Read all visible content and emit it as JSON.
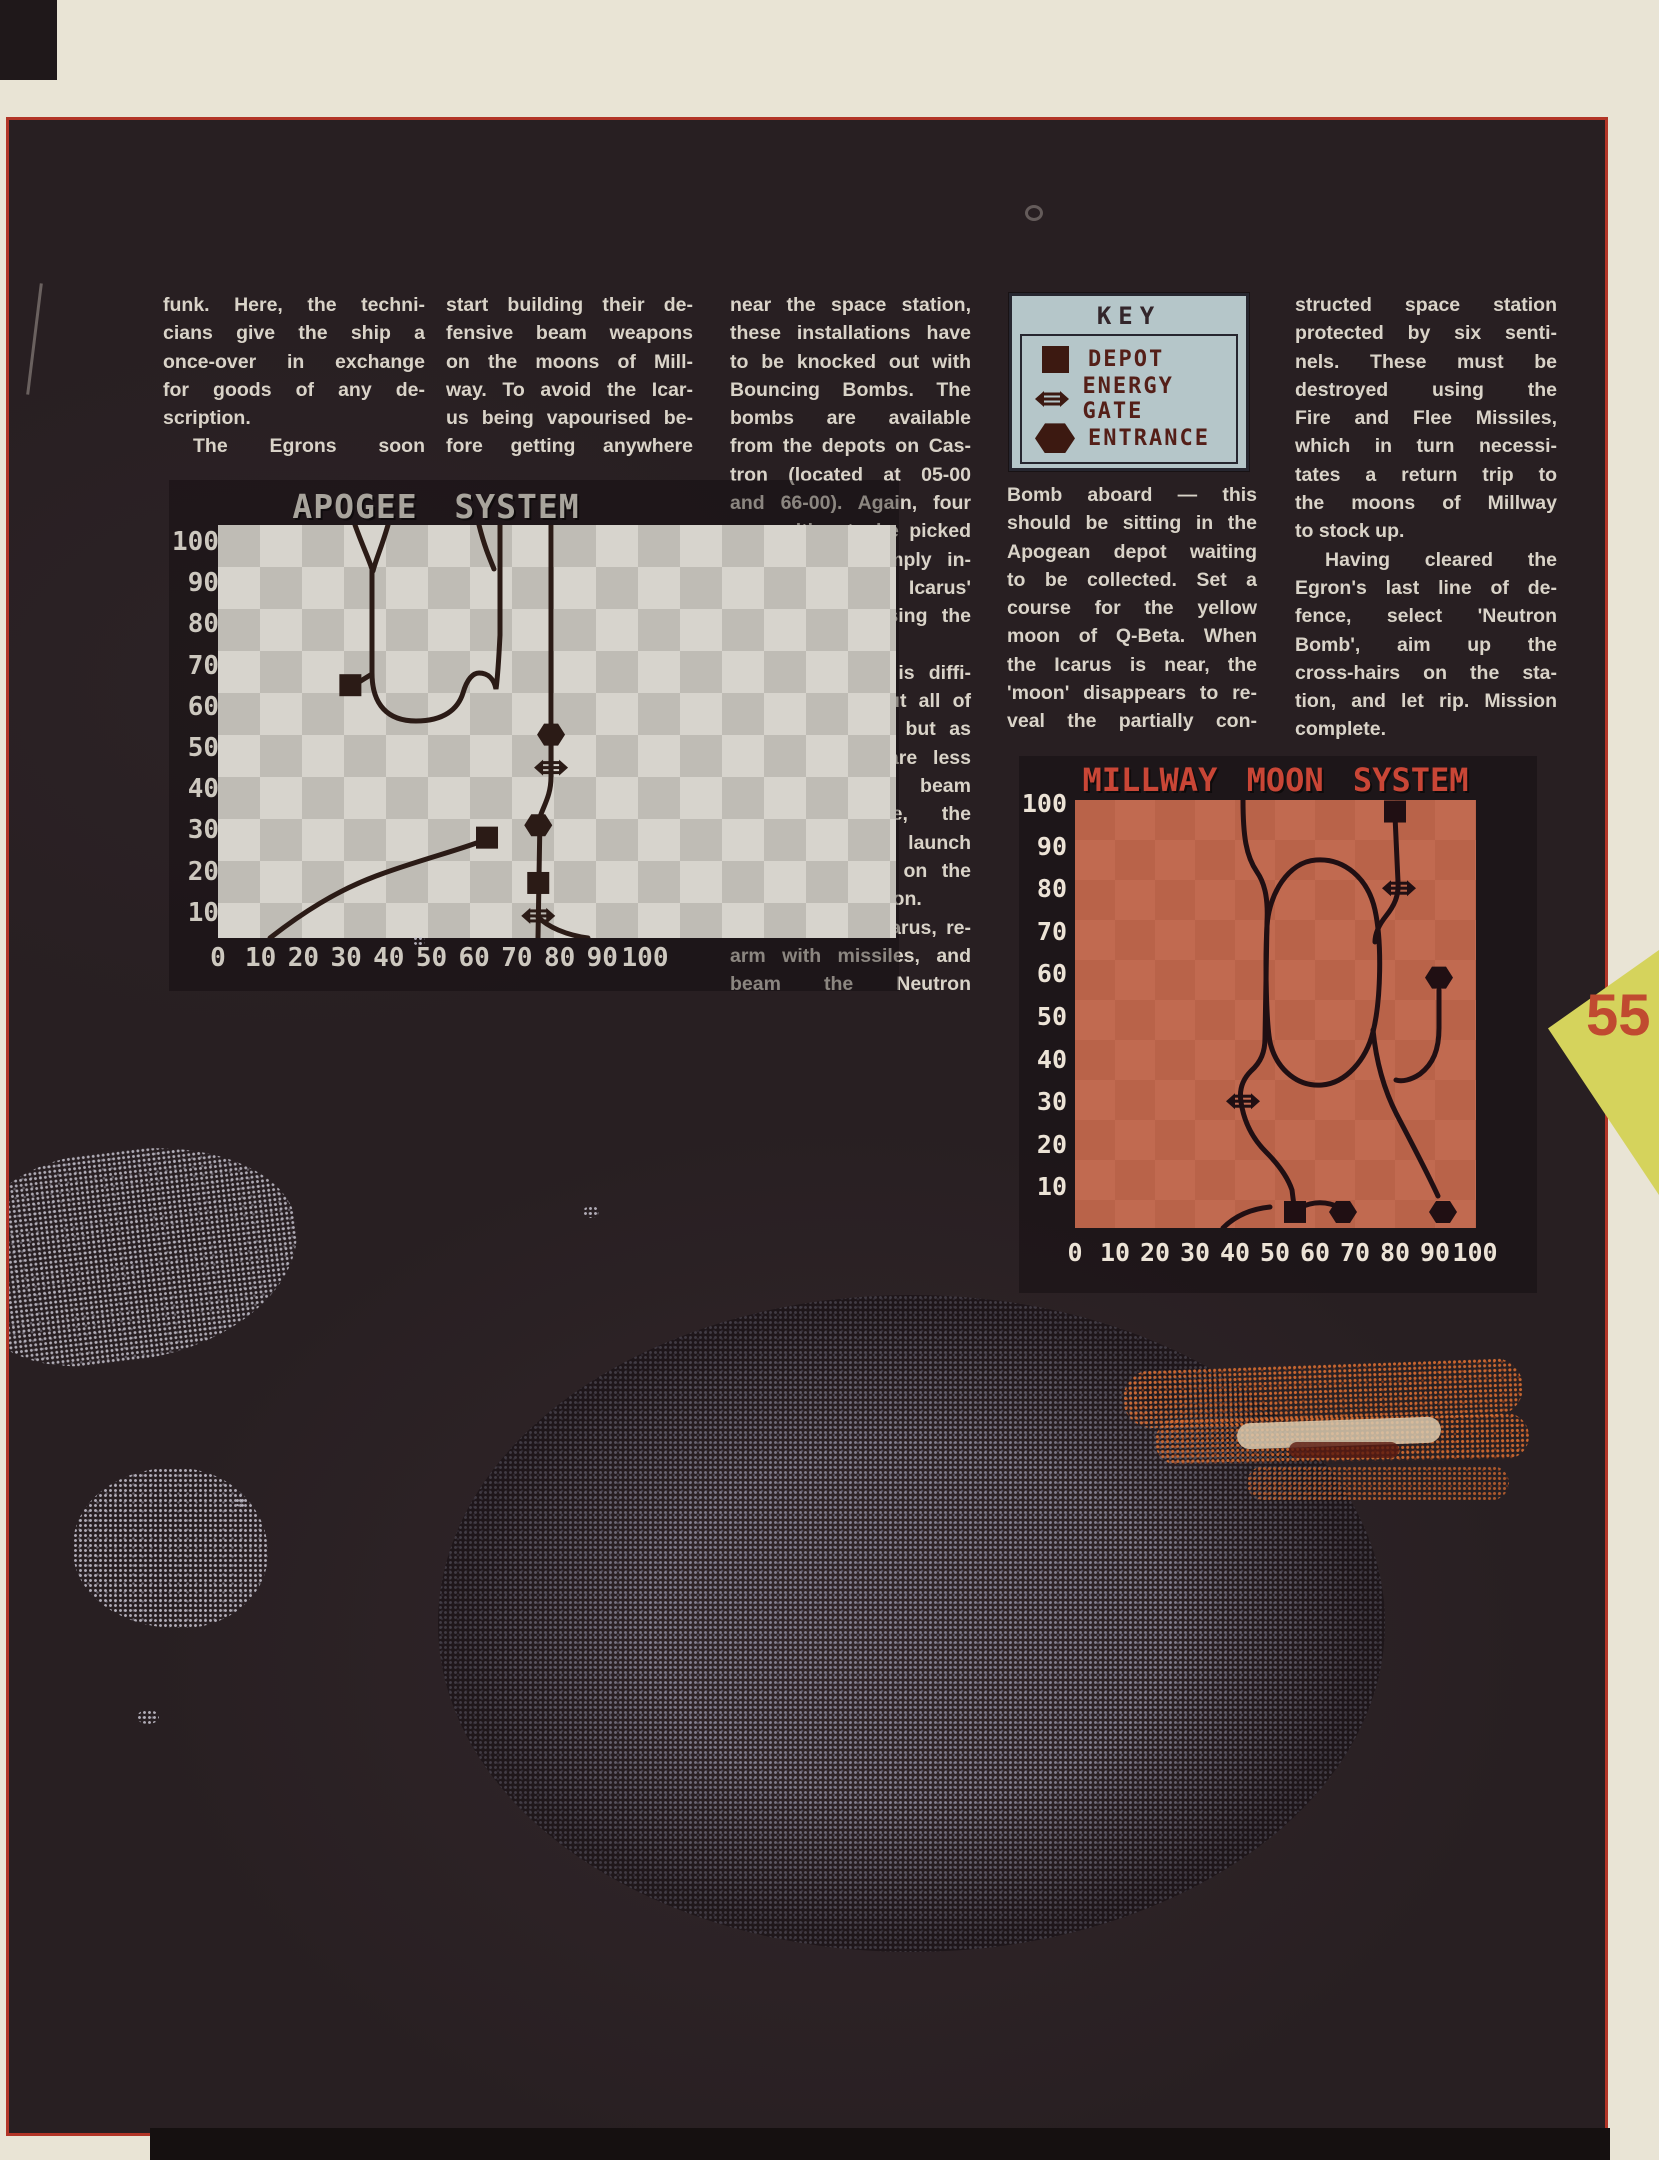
{
  "page": {
    "number": "55"
  },
  "article": {
    "columns": [
      {
        "lines": [
          "funk. Here, the techni-",
          "cians give the ship a",
          "once-over in exchange",
          "for goods of any de-",
          "scription.",
          "  The Egrons soon"
        ]
      },
      {
        "lines": [
          "start building their de-",
          "fensive beam weapons",
          "on the moons of Mill-",
          "way. To avoid the Icar-",
          "us being vapourised be-",
          "fore getting anywhere"
        ]
      },
      {
        "lines": [
          "near the space station,",
          "these installations have",
          "to be knocked out with",
          "Bouncing Bombs. The",
          "bombs are available",
          "from the depots on Cas-",
          "tron (located at 05-00",
          "and 66-00). Again, four",
          "are waiting to be picked",
          "up, and are simply in-",
          "stalled in Icarus'",
          "weapons bay using the",
          "tractor beam.",
          "  Obviously, it is diffi-",
          "cult to knock out all of",
          "the installations, but as",
          "long as there are less",
          "than seven beam",
          "weapons active, the",
          "Icarus is safe to launch",
          "its final assault on the",
          "Egron space station.",
          "  Re-fuel the Icarus, re-",
          "arm with missiles, and",
          "beam the Neutron"
        ]
      },
      {
        "lines": [
          "Bomb aboard — this",
          "should be sitting in the",
          "Apogean depot waiting",
          "to be collected. Set a",
          "course for the yellow",
          "moon of Q-Beta. When",
          "the Icarus is near, the",
          "'moon' disappears to re-",
          "veal the partially con-"
        ]
      },
      {
        "lines": [
          "structed space station",
          "protected by six senti-",
          "nels. These must be",
          "destroyed using the",
          "Fire and Flee Missiles,",
          "which in turn necessi-",
          "tates a return trip to",
          "the moons of Millway",
          "to stock up.",
          "  Having cleared the",
          "Egron's last line of de-",
          "fence, select 'Neutron",
          "Bomb', aim up the",
          "cross-hairs on the sta-",
          "tion, and let rip. Mission",
          "complete."
        ]
      }
    ]
  },
  "key_box": {
    "title": "KEY",
    "items": [
      {
        "icon": "depot",
        "label": "DEPOT"
      },
      {
        "icon": "energy-gate",
        "label": "ENERGY GATE"
      },
      {
        "icon": "entrance",
        "label": "ENTRANCE"
      }
    ]
  },
  "maps": {
    "apogee": {
      "title": "APOGEE SYSTEM",
      "ink": "#2b1b16",
      "y_ticks": [
        "100",
        "90",
        "80",
        "70",
        "60",
        "50",
        "40",
        "30",
        "20",
        "10"
      ],
      "x_ticks": [
        "0",
        "10",
        "20",
        "30",
        "40",
        "50",
        "60",
        "70",
        "80",
        "90",
        "100"
      ],
      "markers": [
        {
          "type": "depot",
          "x": 31,
          "y": 65
        },
        {
          "type": "entrance",
          "x": 78,
          "y": 53
        },
        {
          "type": "energy-gate",
          "x": 78,
          "y": 45
        },
        {
          "type": "depot",
          "x": 63,
          "y": 28
        },
        {
          "type": "entrance",
          "x": 75,
          "y": 31
        },
        {
          "type": "depot",
          "x": 75,
          "y": 17
        },
        {
          "type": "energy-gate",
          "x": 75,
          "y": 9
        }
      ],
      "orbits": [
        "M137,0 C145,22 150,32 154,44 L154,148 C154,180 170,196 198,196 C226,196 240,184 245,168 C249,154 255,148 261,148 C270,148 276,154 278,164 C280,150 281,130 282,110 L282,0",
        "M170,0 C163,24 158,34 155,46",
        "M261,0 C266,20 271,32 276,44",
        "M333,0 L333,252 C333,270 326,280 322,292 L320,413",
        "M52,413 C84,388 118,366 158,351 C198,336 238,326 264,316",
        "M141,157 L154,149",
        "M320,392 C330,402 348,410 370,413"
      ]
    },
    "millway": {
      "title": "MILLWAY MOON SYSTEM",
      "ink": "#200f13",
      "y_ticks": [
        "100",
        "90",
        "80",
        "70",
        "60",
        "50",
        "40",
        "30",
        "20",
        "10"
      ],
      "x_ticks": [
        "0",
        "10",
        "20",
        "30",
        "40",
        "50",
        "60",
        "70",
        "80",
        "90",
        "100"
      ],
      "markers": [
        {
          "type": "depot",
          "x": 80,
          "y": 98
        },
        {
          "type": "energy-gate",
          "x": 81,
          "y": 80
        },
        {
          "type": "entrance",
          "x": 91,
          "y": 59
        },
        {
          "type": "energy-gate",
          "x": 42,
          "y": 30
        },
        {
          "type": "depot",
          "x": 55,
          "y": 4
        },
        {
          "type": "entrance",
          "x": 67,
          "y": 4
        },
        {
          "type": "entrance",
          "x": 92,
          "y": 4
        }
      ],
      "orbits": [
        "M168,0 C168,36 171,56 182,72 C191,85 193,102 192,122 L190,238 C190,252 186,262 176,271 C167,280 164,290 166,302 C169,322 177,338 191,352 C205,366 213,378 217,390 L219,406",
        "M192,126 C194,94 213,62 241,60 C269,58 293,78 300,110 C307,142 306,200 298,232 C291,260 271,283 247,285 C223,287 203,270 196,246 C191,230 190,160 192,126",
        "M320,16 L323,82 C324,96 319,106 311,116 C303,126 300,134 300,142",
        "M298,230 C301,260 309,290 322,315 C335,340 351,370 363,396",
        "M364,190 L364,228 C364,250 358,264 345,274 C336,280 327,282 321,280",
        "M148,428 C159,417 175,409 195,407",
        "M224,408 C240,400 254,402 266,408"
      ]
    }
  },
  "colors": {
    "paper": "#e9e4d5",
    "page_bg": "#281f22",
    "border_red": "#b23527",
    "body_text": "#d9d3c8",
    "arrow_yellow": "#d5d35c",
    "page_number": "#c04a30",
    "key_bg": "#b5c6c9",
    "key_ink": "#541f18",
    "key_icon": "#3c1911",
    "key_frame": "#26262f",
    "apogee_c1": "#d7d4cd",
    "apogee_c2": "#bfbcb5",
    "apogee_title": "#a8a49c",
    "apogee_label": "#cdc8bf",
    "millway_c1": "#c16a50",
    "millway_c2": "#b96349",
    "millway_title": "#c94636",
    "millway_label": "#ece3d6"
  }
}
